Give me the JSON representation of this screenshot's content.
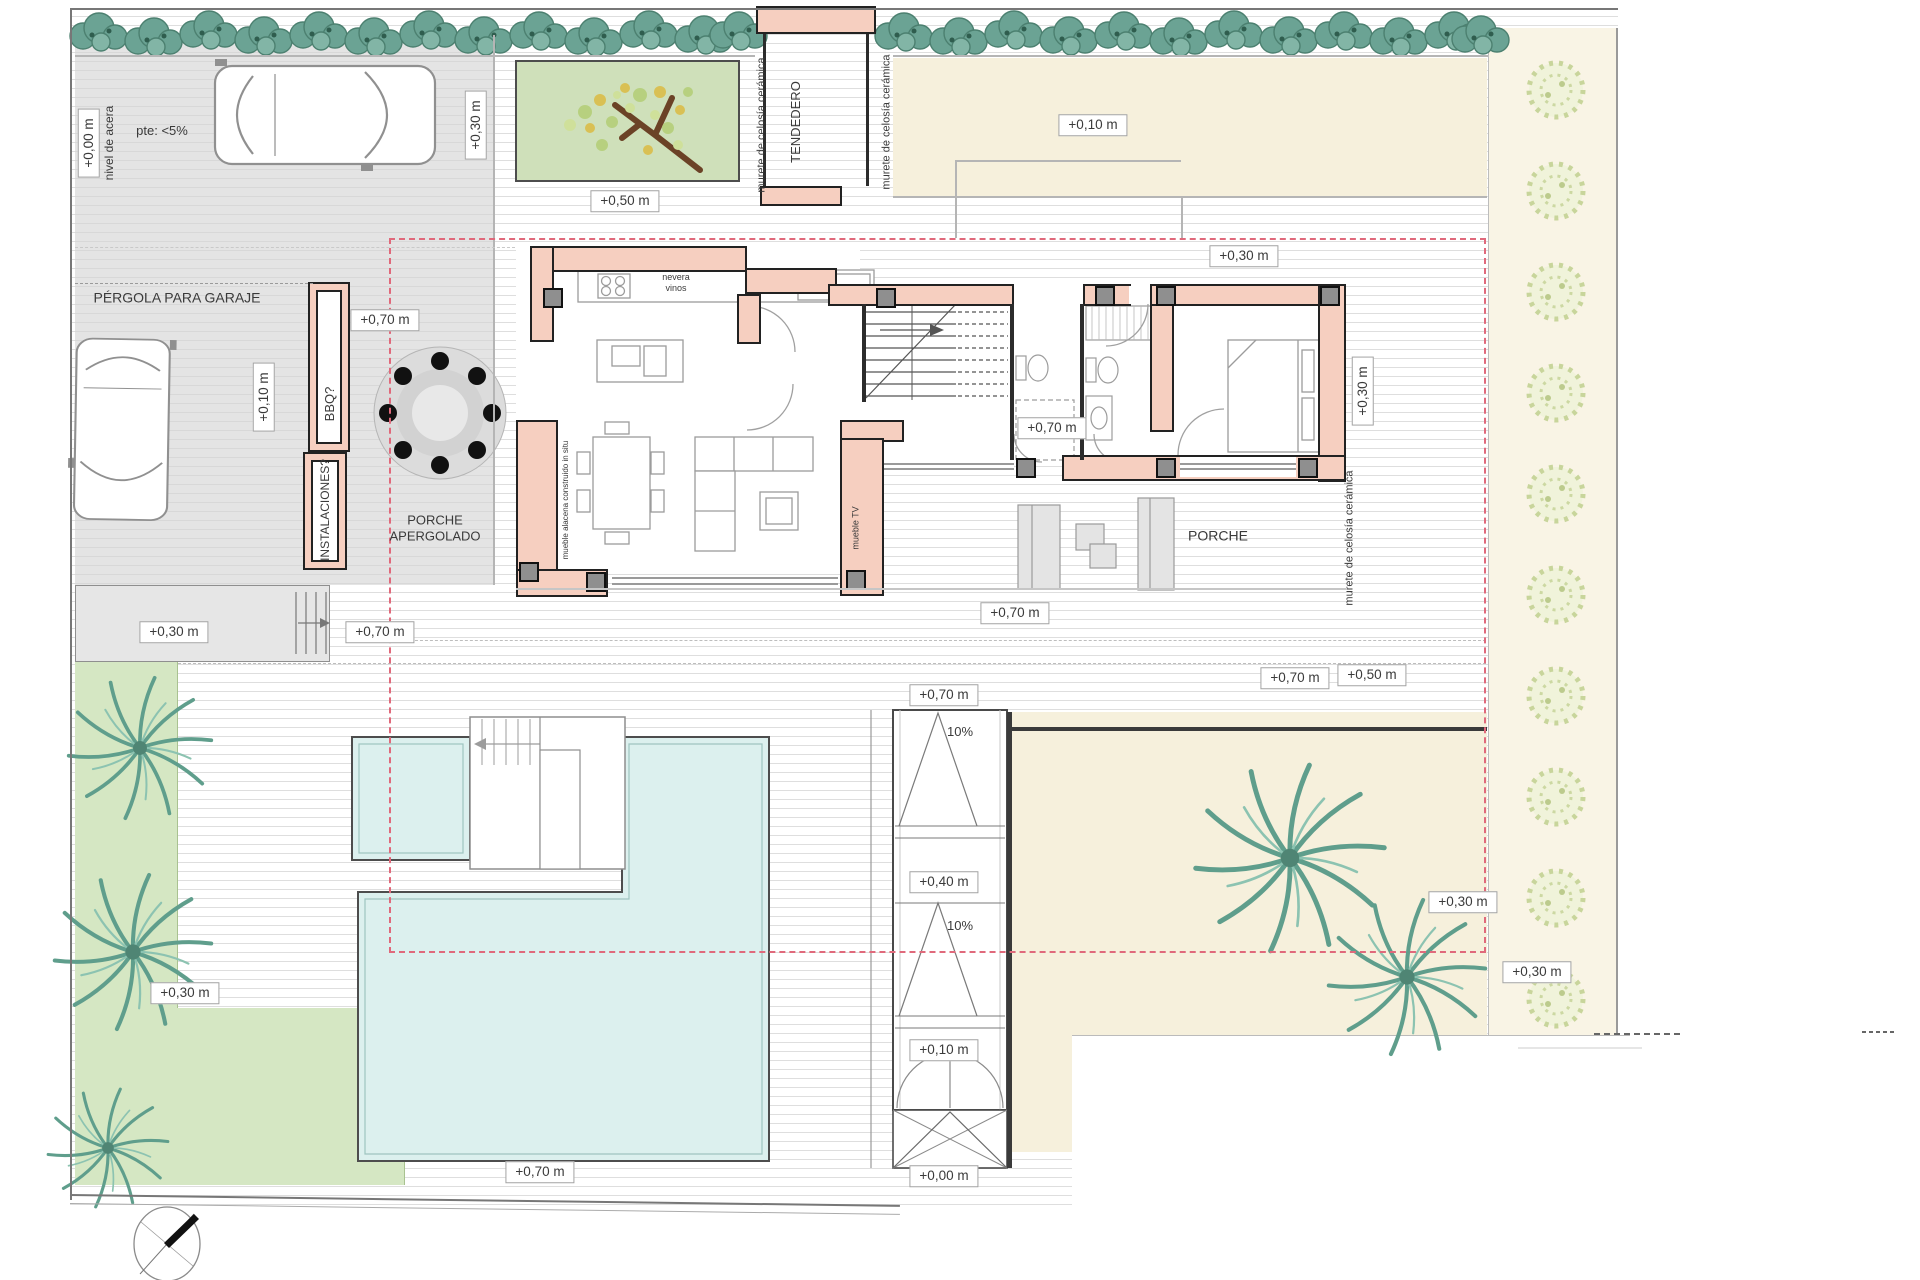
{
  "plan": {
    "kind": "architectural site / floor plan",
    "colors": {
      "wall_fill": "#f6cfc0",
      "wall_outline": "#222222",
      "paving_gray": "#e4e4e4",
      "gravel_beige": "#f6f0dc",
      "grass_green": "#d5e7c3",
      "hedge_green": "#6ba394",
      "pool_blue": "#dcf0ee",
      "setback_dashed_pink": "#e0697b"
    }
  },
  "annotations": [
    {
      "name": "elev-garage-street",
      "text": "+0,00 m",
      "x": 89,
      "y": 143,
      "box": true,
      "vertical": true
    },
    {
      "name": "note-nivel-acera",
      "text": "nivel de acera",
      "x": 109,
      "y": 143,
      "box": false,
      "vertical": true,
      "size": 12
    },
    {
      "name": "note-pendiente",
      "text": "pte: <5%",
      "x": 162,
      "y": 131,
      "box": false,
      "vertical": false,
      "size": 13
    },
    {
      "name": "elev-top-garden",
      "text": "+0,30 m",
      "x": 476,
      "y": 125,
      "box": true,
      "vertical": true
    },
    {
      "name": "elev-garden-patch",
      "text": "+0,50 m",
      "x": 625,
      "y": 201,
      "box": true,
      "vertical": false
    },
    {
      "name": "note-murete-left",
      "text": "murete de celosía cerámica",
      "x": 762,
      "y": 125,
      "box": false,
      "vertical": true,
      "size": 11
    },
    {
      "name": "room-tendedero",
      "text": "TENDEDERO",
      "x": 796,
      "y": 122,
      "box": false,
      "vertical": true,
      "size": 13
    },
    {
      "name": "note-murete-right",
      "text": "murete de celosía cerámica",
      "x": 887,
      "y": 122,
      "box": false,
      "vertical": true,
      "size": 11
    },
    {
      "name": "elev-northeast-yard",
      "text": "+0,10 m",
      "x": 1093,
      "y": 125,
      "box": true,
      "vertical": false
    },
    {
      "name": "note-pergola-garaje",
      "text": "PÉRGOLA PARA GARAJE",
      "x": 177,
      "y": 298,
      "box": false,
      "vertical": false,
      "size": 14
    },
    {
      "name": "elev-deck-top",
      "text": "+0,70 m",
      "x": 385,
      "y": 320,
      "box": true,
      "vertical": false
    },
    {
      "name": "elev-garage-inner",
      "text": "+0,10 m",
      "x": 264,
      "y": 397,
      "box": true,
      "vertical": true
    },
    {
      "name": "note-bbq",
      "text": "BBQ?",
      "x": 330,
      "y": 404,
      "box": false,
      "vertical": true,
      "size": 13
    },
    {
      "name": "note-instalaciones",
      "text": "INSTALACIONES?",
      "x": 325,
      "y": 510,
      "box": false,
      "vertical": true,
      "size": 12
    },
    {
      "name": "room-porche-apergolado",
      "text": "PORCHE\nAPERGOLADO",
      "x": 435,
      "y": 528,
      "box": false,
      "vertical": false,
      "size": 13
    },
    {
      "name": "elev-entry-court",
      "text": "+0,30 m",
      "x": 1244,
      "y": 256,
      "box": true,
      "vertical": false
    },
    {
      "name": "elev-bedroom-side",
      "text": "+0,30 m",
      "x": 1363,
      "y": 391,
      "box": true,
      "vertical": true
    },
    {
      "name": "note-murete-east",
      "text": "murete de celosía cerámica",
      "x": 1350,
      "y": 538,
      "box": false,
      "vertical": true,
      "size": 11
    },
    {
      "name": "label-nevera-vinos",
      "text": "nevera\nvinos",
      "x": 676,
      "y": 283,
      "box": false,
      "vertical": false,
      "size": 9
    },
    {
      "name": "label-mueble-alacena",
      "text": "mueble alacena construido in situ",
      "x": 566,
      "y": 500,
      "box": false,
      "vertical": true,
      "size": 8
    },
    {
      "name": "label-mueble-tv",
      "text": "mueble TV",
      "x": 856,
      "y": 528,
      "box": false,
      "vertical": true,
      "size": 9
    },
    {
      "name": "elev-hall",
      "text": "+0,70 m",
      "x": 1052,
      "y": 428,
      "box": true,
      "vertical": false
    },
    {
      "name": "room-porche",
      "text": "PORCHE",
      "x": 1218,
      "y": 536,
      "box": false,
      "vertical": false,
      "size": 14
    },
    {
      "name": "elev-porch-deck",
      "text": "+0,70 m",
      "x": 1015,
      "y": 613,
      "box": true,
      "vertical": false
    },
    {
      "name": "elev-deck-east-a",
      "text": "+0,70 m",
      "x": 1295,
      "y": 678,
      "box": true,
      "vertical": false
    },
    {
      "name": "elev-deck-east-b",
      "text": "+0,50 m",
      "x": 1372,
      "y": 675,
      "box": true,
      "vertical": false
    },
    {
      "name": "elev-driveway",
      "text": "+0,30 m",
      "x": 174,
      "y": 632,
      "box": true,
      "vertical": false
    },
    {
      "name": "elev-deck-west",
      "text": "+0,70 m",
      "x": 380,
      "y": 632,
      "box": true,
      "vertical": false
    },
    {
      "name": "elev-ramp-top",
      "text": "+0,70 m",
      "x": 944,
      "y": 695,
      "box": true,
      "vertical": false
    },
    {
      "name": "note-ramp-slope-1",
      "text": "10%",
      "x": 960,
      "y": 732,
      "box": false,
      "vertical": false,
      "size": 13
    },
    {
      "name": "elev-ramp-mid",
      "text": "+0,40 m",
      "x": 944,
      "y": 882,
      "box": true,
      "vertical": false
    },
    {
      "name": "note-ramp-slope-2",
      "text": "10%",
      "x": 960,
      "y": 926,
      "box": false,
      "vertical": false,
      "size": 13
    },
    {
      "name": "elev-ramp-low",
      "text": "+0,10 m",
      "x": 944,
      "y": 1050,
      "box": true,
      "vertical": false
    },
    {
      "name": "elev-ramp-street",
      "text": "+0,00 m",
      "x": 944,
      "y": 1176,
      "box": true,
      "vertical": false
    },
    {
      "name": "elev-southeast-yard",
      "text": "+0,30 m",
      "x": 1463,
      "y": 902,
      "box": true,
      "vertical": false
    },
    {
      "name": "elev-east-edge",
      "text": "+0,30 m",
      "x": 1537,
      "y": 972,
      "box": true,
      "vertical": false
    },
    {
      "name": "elev-southwest-grass",
      "text": "+0,30 m",
      "x": 185,
      "y": 993,
      "box": true,
      "vertical": false
    },
    {
      "name": "elev-pool-deck",
      "text": "+0,70 m",
      "x": 540,
      "y": 1172,
      "box": true,
      "vertical": false
    }
  ]
}
